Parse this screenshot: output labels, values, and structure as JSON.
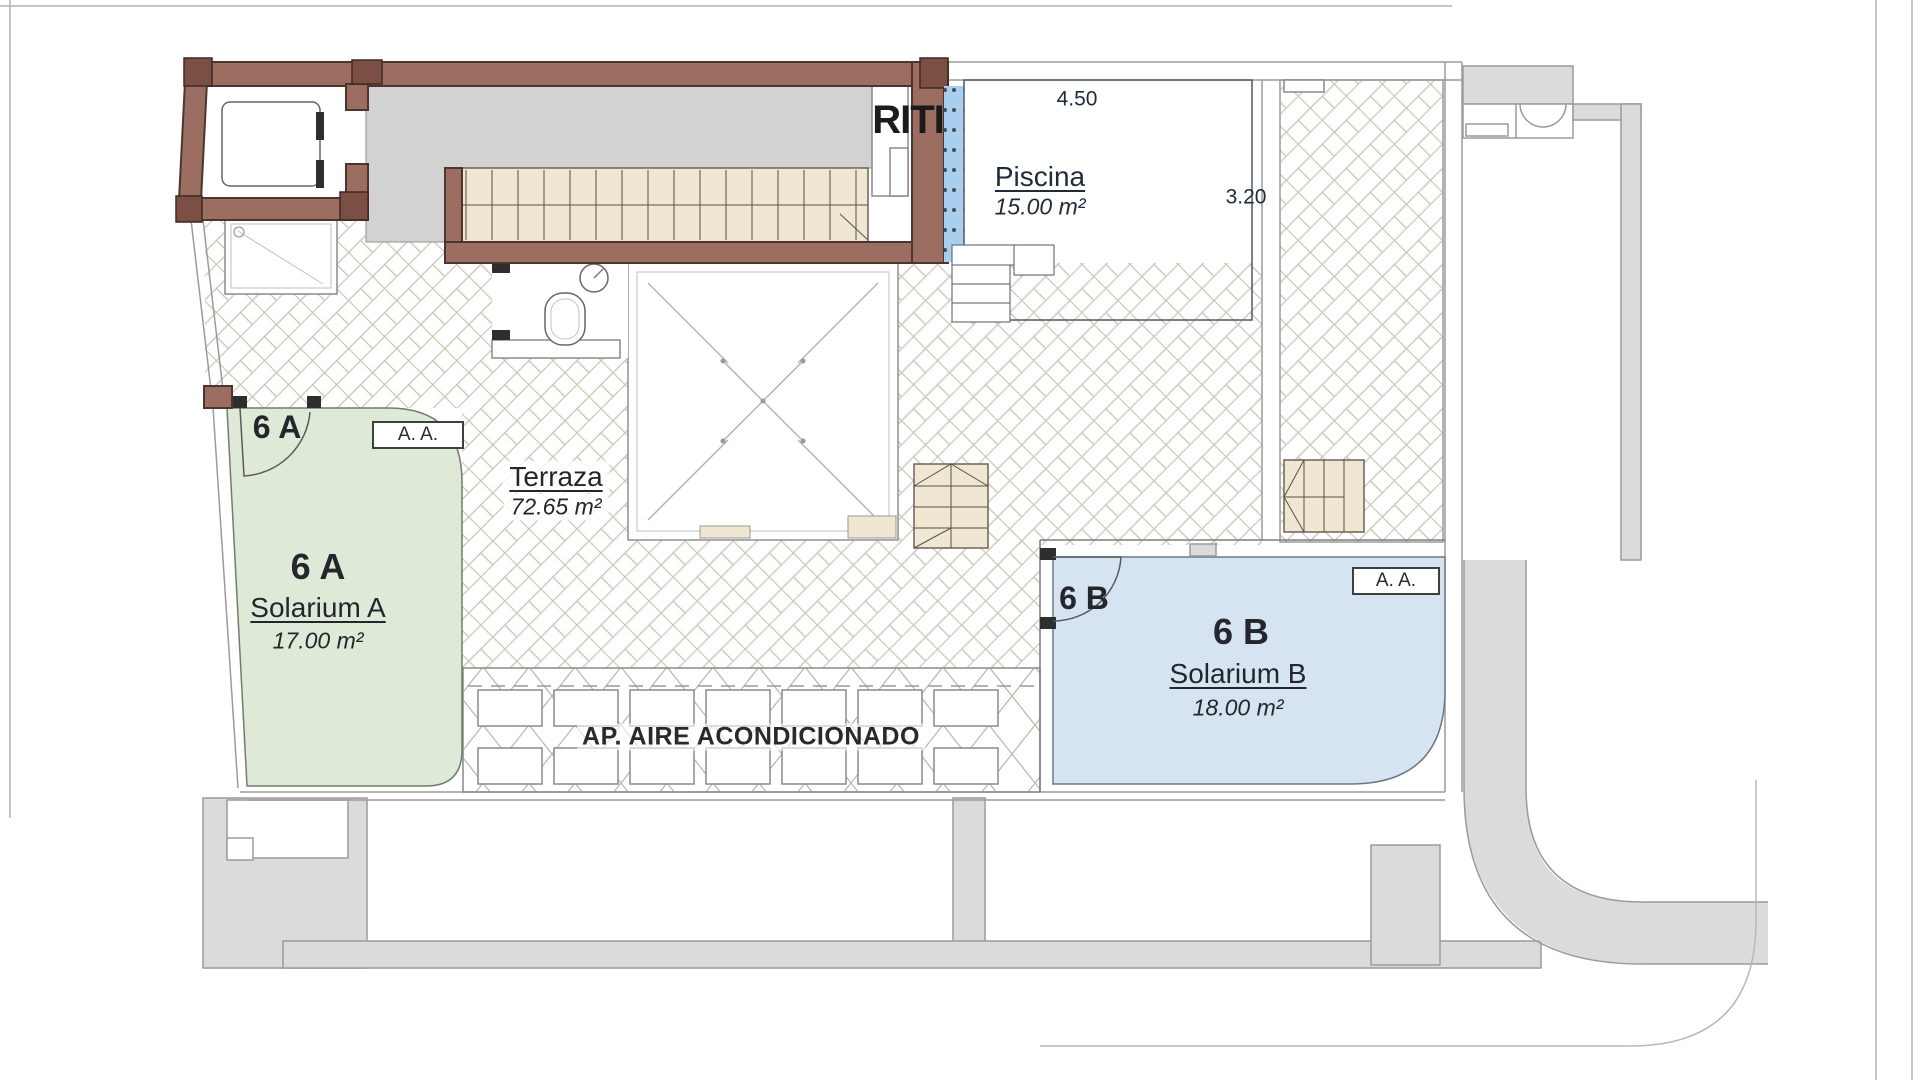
{
  "plan_type": "rooftop-solarium-floor-plan",
  "labels": {
    "riti": "RITI",
    "pool_name": "Piscina",
    "pool_area": "15.00 m²",
    "pool_dim_width": "4.50",
    "pool_dim_depth": "3.20",
    "terrace_name": "Terraza",
    "terrace_area": "72.65 m²",
    "unit_a_door": "6 A",
    "unit_a": "6 A",
    "unit_a_name": "Solarium A",
    "unit_a_area": "17.00 m²",
    "unit_a_badge": "A. A.",
    "unit_b_door": "6 B",
    "unit_b": "6 B",
    "unit_b_name": "Solarium B",
    "unit_b_area": "18.00 m²",
    "unit_b_badge": "A. A.",
    "ac_area": "AP. AIRE ACONDICIONADO"
  },
  "colors": {
    "wall_brown": "#9c6e61",
    "wall_dark": "#7b4f43",
    "pool_blue": "#a9ceef",
    "solarium_a_green": "#dfe9d8",
    "solarium_b_blue": "#d5e4f0",
    "stair_beige": "#efe7d2",
    "landing_gray": "#d2d2d2",
    "walkway_gray": "#dbdbdb",
    "text_dark": "#23272d",
    "pool_text": "#1e2b3a"
  }
}
